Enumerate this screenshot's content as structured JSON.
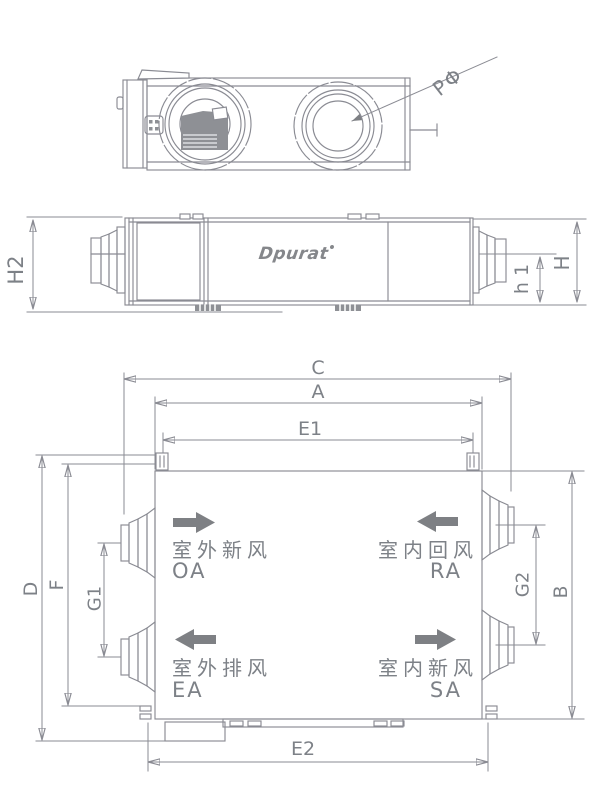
{
  "drawing": {
    "brand": {
      "logo_text": "Dpurat"
    },
    "top_view": {
      "diameter_label": "PΦ"
    },
    "side_view": {
      "dims": {
        "h2": "H2",
        "h1": "h 1",
        "h": "H"
      }
    },
    "plan_view": {
      "dims": {
        "c": "C",
        "a": "A",
        "e1": "E1",
        "e2": "E2",
        "d": "D",
        "f": "F",
        "g1": "G1",
        "g2": "G2",
        "b": "B"
      },
      "ports": [
        {
          "label_cn": "室外新风",
          "code": "OA"
        },
        {
          "label_cn": "室内回风",
          "code": "RA"
        },
        {
          "label_cn": "室外排风",
          "code": "EA"
        },
        {
          "label_cn": "室内新风",
          "code": "SA"
        }
      ]
    },
    "colors": {
      "line": "#8a8b93",
      "text": "#7d8187",
      "arrow": "#7e8084"
    }
  }
}
